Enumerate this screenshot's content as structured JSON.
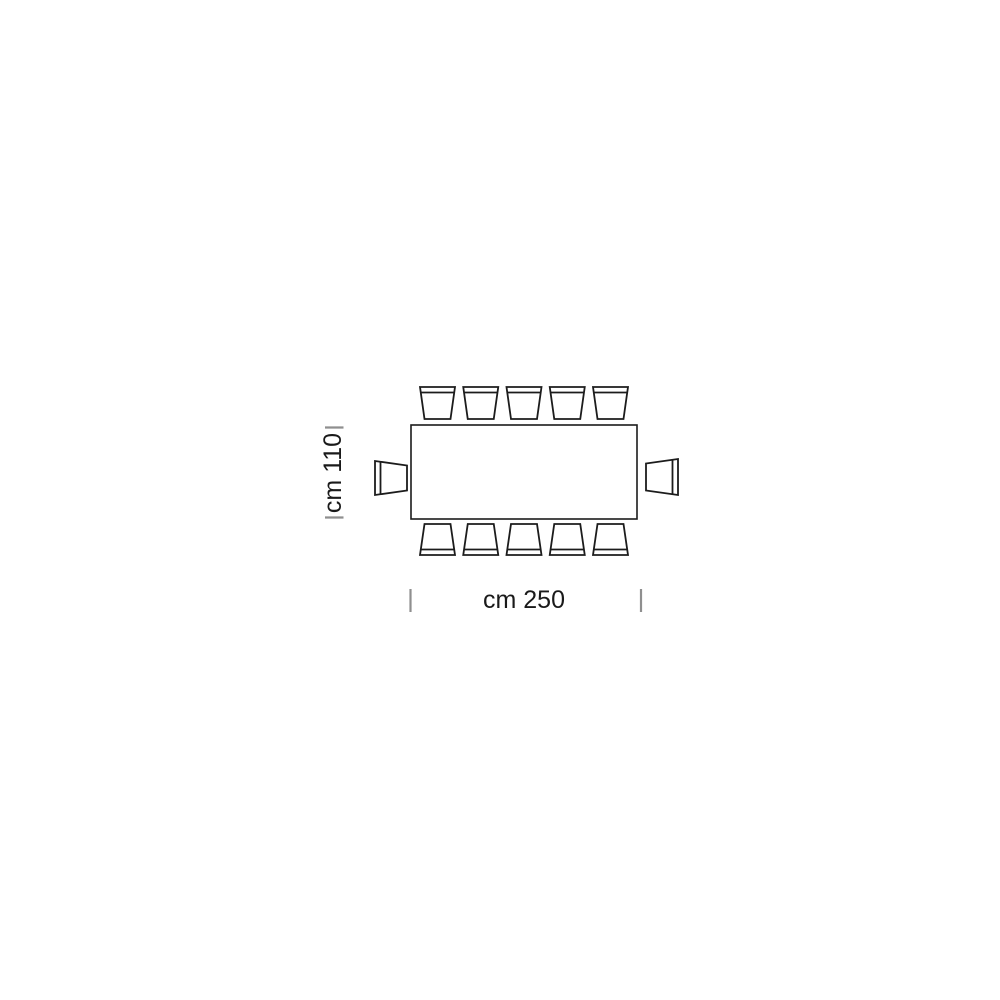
{
  "page": {
    "background": "#ffffff"
  },
  "diagram": {
    "kind": "table-seating-plan-top-view",
    "table": {
      "shape": "rectangle",
      "width_label": "cm 250",
      "depth_label": "cm 110"
    },
    "seats": {
      "top": 5,
      "bottom": 5,
      "left": 1,
      "right": 1,
      "total": 12
    },
    "colors": {
      "line": "#1c1c1c",
      "tick": "#8f8f8f",
      "text": "#1a1a1a",
      "fill": "#ffffff"
    }
  }
}
